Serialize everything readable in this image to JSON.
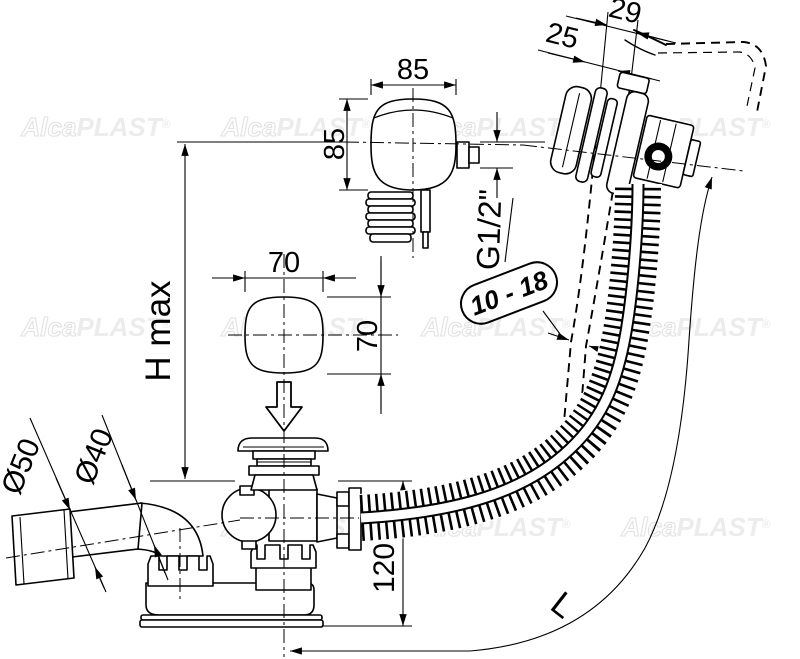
{
  "watermark": {
    "alca": "Alca",
    "plast": "PLAST",
    "reg": "®",
    "full": "AlcaPLAST®"
  },
  "labels": {
    "dim_29": "29",
    "dim_25": "25",
    "dim_85_width": "85",
    "dim_85_height": "85",
    "thread_size": "G1/2\"",
    "wall_thickness_range": "10 - 18",
    "height_max": "H max",
    "dim_70_width": "70",
    "dim_70_height": "70",
    "dia_outlet_50": "Ø50",
    "dia_outlet_40": "Ø40",
    "dim_120": "120",
    "hose_length": "L"
  },
  "colors": {
    "line": "#000000",
    "background": "#ffffff",
    "watermark": "#ececec"
  }
}
